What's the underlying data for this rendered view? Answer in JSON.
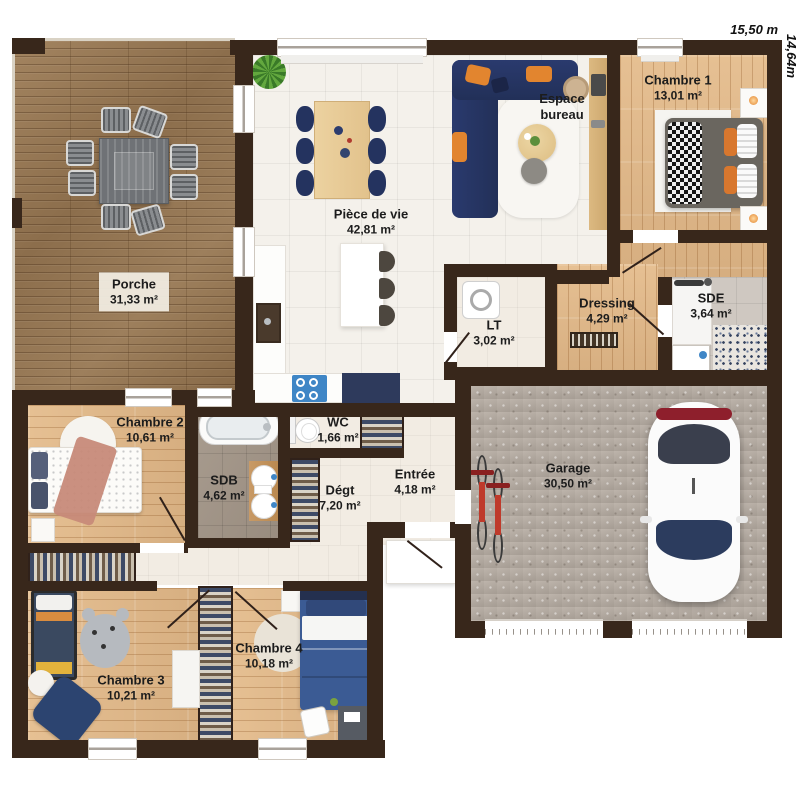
{
  "dimensions": {
    "width": "15,50 m",
    "height": "14,64m"
  },
  "rooms": {
    "porche": {
      "name": "Porche",
      "area": "31,33 m²"
    },
    "piece_de_vie": {
      "name": "Pièce de vie",
      "area": "42,81 m²"
    },
    "espace_bureau": {
      "name": "Espace bureau"
    },
    "chambre1": {
      "name": "Chambre 1",
      "area": "13,01 m²"
    },
    "dressing": {
      "name": "Dressing",
      "area": "4,29 m²"
    },
    "sde": {
      "name": "SDE",
      "area": "3,64 m²"
    },
    "lt": {
      "name": "LT",
      "area": "3,02 m²"
    },
    "wc": {
      "name": "WC",
      "area": "1,66 m²"
    },
    "sdb": {
      "name": "SDB",
      "area": "4,62 m²"
    },
    "degt": {
      "name": "Dégt",
      "area": "7,20 m²"
    },
    "entree": {
      "name": "Entrée",
      "area": "4,18 m²"
    },
    "garage": {
      "name": "Garage",
      "area": "30,50 m²"
    },
    "chambre2": {
      "name": "Chambre 2",
      "area": "10,61 m²"
    },
    "chambre3": {
      "name": "Chambre 3",
      "area": "10,21 m²"
    },
    "chambre4": {
      "name": "Chambre 4",
      "area": "10,18 m²"
    }
  },
  "colors": {
    "wall": "#38271b",
    "deck": "#96774f",
    "wood_floor": "#dfb88c",
    "tile": "#f4f1eb",
    "concrete": "#b3aaa1",
    "sofa_navy": "#273569",
    "accent_orange": "#e2852f",
    "car_white": "#fbfbfb",
    "bike_red": "#bf3a2b"
  }
}
